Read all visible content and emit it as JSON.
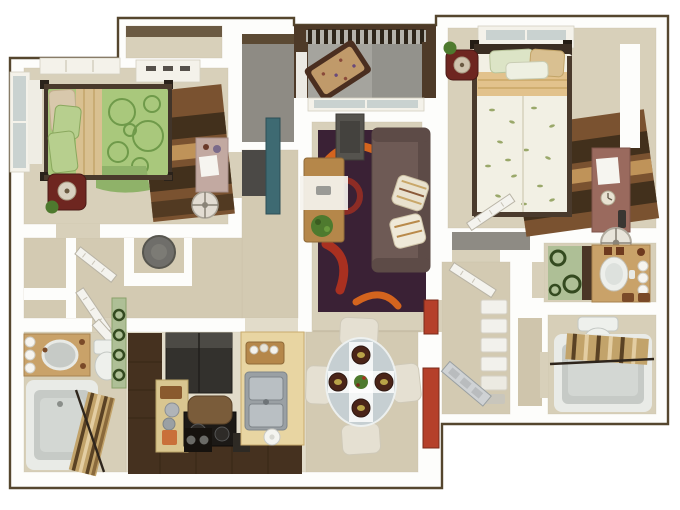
{
  "scene": {
    "type": "3d-floor-plan-top-down-render",
    "description": "two-bedroom two-bath apartment with balcony",
    "rooms": [
      {
        "id": "bedroom-1",
        "position": "top-left",
        "furniture": [
          "green-bed",
          "nightstand-lamp",
          "brown-striped-rug",
          "desk",
          "round-chair",
          "dresser",
          "windows"
        ]
      },
      {
        "id": "bedroom-1-closet",
        "position": "top",
        "furniture": [
          "shelf"
        ]
      },
      {
        "id": "storage-closet",
        "position": "top-center",
        "furniture": []
      },
      {
        "id": "balcony",
        "position": "top-center",
        "furniture": [
          "railing",
          "floral-bench"
        ]
      },
      {
        "id": "bedroom-2",
        "position": "top-right",
        "furniture": [
          "floral-white-bed",
          "nightstand-lamp",
          "brown-striped-rug",
          "desk",
          "round-chair",
          "window"
        ]
      },
      {
        "id": "living-room",
        "position": "center",
        "furniture": [
          "purple-swirl-rug",
          "sofa",
          "coffee-table",
          "plant",
          "media-cabinet",
          "sliding-door"
        ]
      },
      {
        "id": "dining-area",
        "position": "bottom-center",
        "furniture": [
          "round-glass-table",
          "four-chairs",
          "four-place-settings",
          "centerpiece"
        ]
      },
      {
        "id": "kitchen",
        "position": "bottom-left",
        "furniture": [
          "l-shaped-dark-cabinets",
          "refrigerator",
          "stove",
          "island",
          "double-sink",
          "cutting-board",
          "plate",
          "speaker-box"
        ]
      },
      {
        "id": "bathroom-1",
        "position": "left-bottom",
        "furniture": [
          "vanity-sink",
          "vanity-lights",
          "toilet",
          "tub",
          "shower-curtain"
        ]
      },
      {
        "id": "hall-nook",
        "position": "middle-left",
        "furniture": [
          "gray-round-chair",
          "closet-doors"
        ]
      },
      {
        "id": "walk-in-closet",
        "position": "right-center",
        "furniture": []
      },
      {
        "id": "bathroom-2-vanity",
        "position": "right",
        "furniture": [
          "vanity-sink",
          "vanity-lights",
          "green-mat"
        ]
      },
      {
        "id": "tub-room",
        "position": "bottom-right",
        "furniture": [
          "tub",
          "shower-curtain",
          "toilet"
        ]
      },
      {
        "id": "entry-hall",
        "position": "bottom-right-center",
        "furniture": [
          "front-door",
          "red-accent-door",
          "linen-shelves"
        ]
      }
    ]
  },
  "palette": {
    "wall": "#fdfdfb",
    "outline": "#55462e",
    "floor_tan": "#d8d0ba",
    "floor_tan2": "#d3cab2",
    "floor_tile": "#e2dcca",
    "floor_bath": "#d7cfb8",
    "floor_gray": "#8e8b84",
    "balcony_floor": "#a5a49e",
    "balcony_wall": "#4e3a28",
    "glass": "#c9d2d0",
    "bed_green": "#a9c87c",
    "duvet_white": "#f2f0e4",
    "pillow_tan": "#d9c091",
    "rug_brown": "#7a5230",
    "rug_purple": "#3a2135",
    "swirl_orange": "#d4641e",
    "swirl_red": "#a93020",
    "sofa_brown": "#6e5a55",
    "wood": "#b5874a",
    "plant_green": "#4e7a2e",
    "cabinet_dark": "#45311f",
    "counter_tan": "#e8d5a2",
    "steel": "#9aa0a4",
    "chair_cream": "#e5e0d2",
    "tub_gray": "#c6cac6",
    "curtain_tan": "#c2a36a",
    "vanity_tan": "#c9a269",
    "accent_red": "#b5402a",
    "door_silver": "#cfd2d4",
    "nightstand_red": "#6e2620",
    "media_gray": "#55534e",
    "teal": "#3e6a72"
  }
}
